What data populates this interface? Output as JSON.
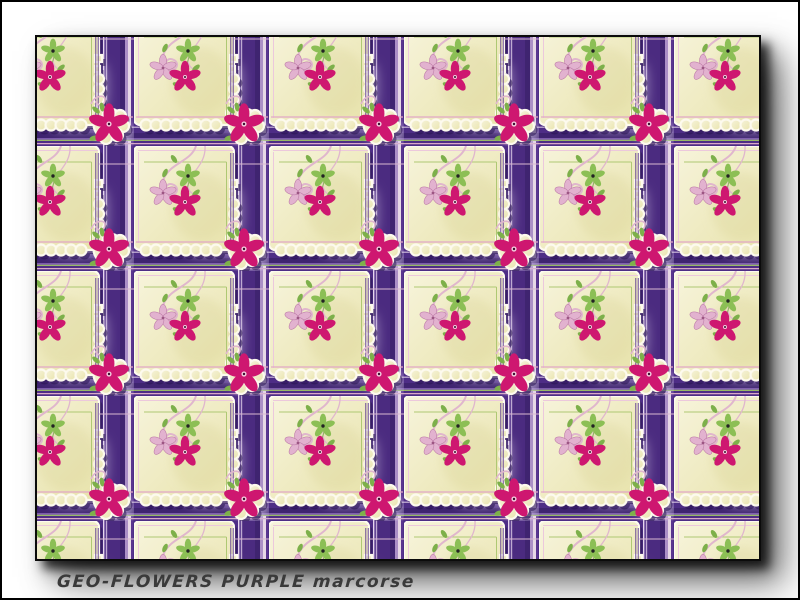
{
  "window": {
    "width_px": 800,
    "height_px": 600,
    "background": "#ffffff",
    "border_color": "#000000"
  },
  "caption": {
    "text": "GEO-FLOWERS PURPLE marcorse",
    "pattern_title": "GEO-FLOWERS PURPLE",
    "designer": "marcorse",
    "color": "#3a3a3a"
  },
  "swatch": {
    "description": "Repeating pattern: cream scallop-edged handkerchief tiles on a purple plaid grid with magenta, pink and green five-petal flowers and pink vine curls",
    "grid": {
      "columns_visible": 6,
      "rows_visible": 5,
      "tile_repeat_px": {
        "width": 135,
        "height": 125
      }
    },
    "colors": {
      "purple": "#4e2d86",
      "purple_dark": "#3f2470",
      "purple_line": "#5a3590",
      "lavender": "#ab8fc6",
      "pale_stripe": "#e7d8e6",
      "cream": "#f2eec6",
      "cream_deep": "#e8e3ab",
      "white_edge": "#fdfaee",
      "magenta": "#ce1770",
      "pink_flower": "#e2b2cf",
      "vine_pink": "#e0b6cd",
      "green": "#7db04a",
      "line_green": "#aec873",
      "line_pink": "#e2a8c6",
      "flower_center_light": "#f3cbdd",
      "flower_center_dark": "#3c1030"
    }
  }
}
